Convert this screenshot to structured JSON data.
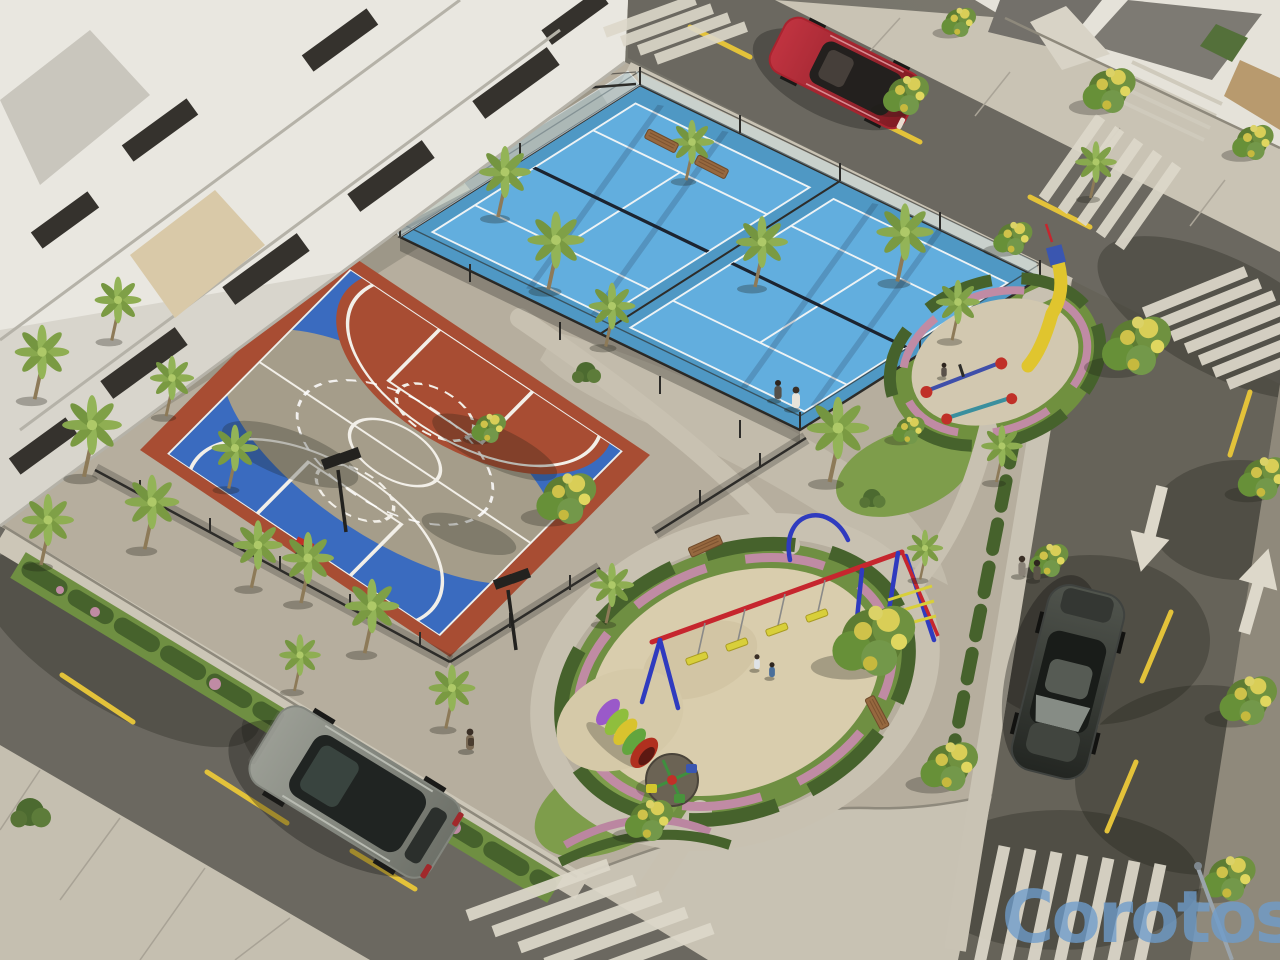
{
  "watermark": {
    "text": "Corotos",
    "color": "#6e9dcc"
  },
  "palette": {
    "asphalt": "#6e6b62",
    "asphalt_dark": "#5f5c55",
    "park_paving": "#b6ae9e",
    "sidewalk": "#ccc6b7",
    "plaza": "#c8c2b3",
    "court_blue": "#3a6bbf",
    "court_terracotta": "#a84d33",
    "court_center": "#a59d8a",
    "court_line": "#f2efe8",
    "padel_blue": "#62aede",
    "padel_surround": "#4f98c4",
    "grass": "#7e9d4b",
    "hedge": "#46622c",
    "foliage": "#6f9140",
    "flower_yellow": "#d9ce57",
    "flower_pink": "#c08ba4",
    "sand": "#d9cdad",
    "bleacher": "#cfc2a4",
    "marking_white": "#ddd8ca",
    "marking_yellow": "#e3c23a",
    "car_red": "#a8242f",
    "car_gray": "#83867e",
    "car_dark": "#3f423f",
    "swing_blue": "#2f3bbf",
    "swing_red": "#c6262e",
    "seat_yellow": "#d8cf3a",
    "slide_yellow": "#e0c52e",
    "bench_wood": "#96683f",
    "fence_dark": "#2d2c29"
  }
}
